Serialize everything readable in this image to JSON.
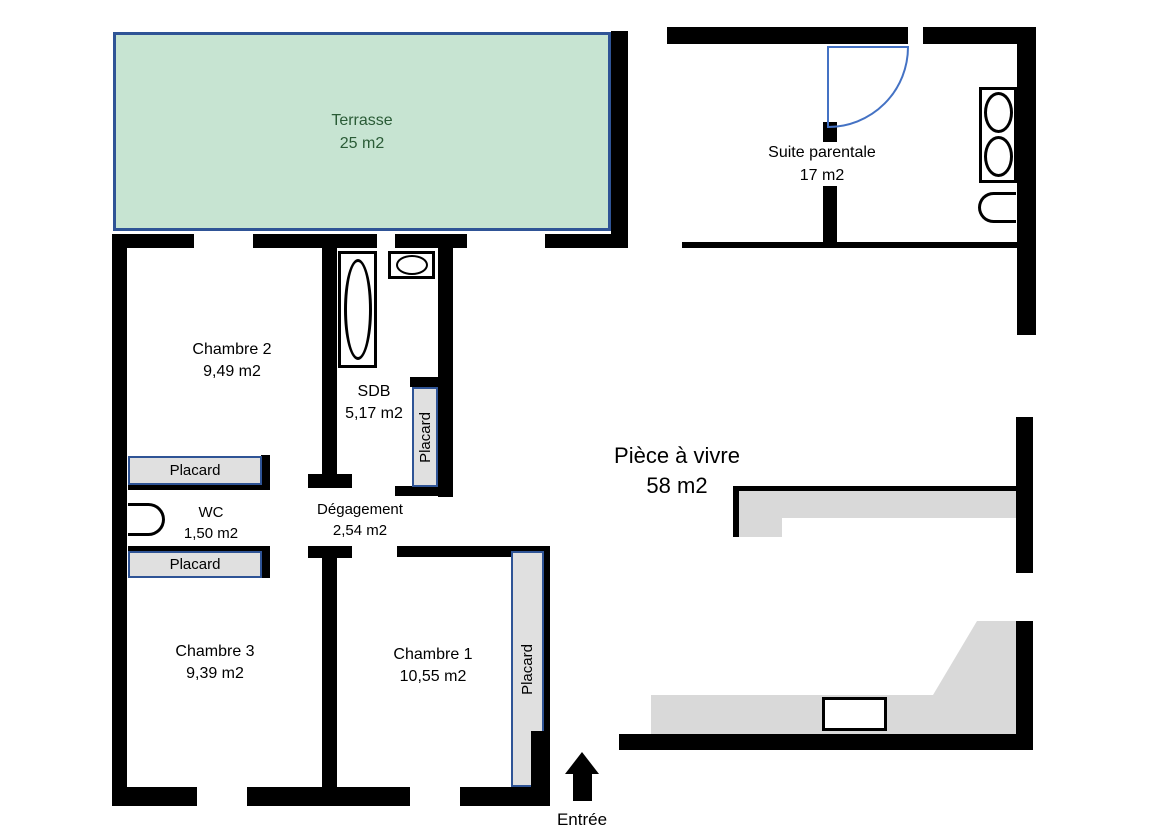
{
  "rooms": {
    "terrasse": {
      "name": "Terrasse",
      "area": "25 m2"
    },
    "suite_parentale": {
      "name": "Suite parentale",
      "area": "17 m2"
    },
    "chambre2": {
      "name": "Chambre 2",
      "area": "9,49 m2"
    },
    "sdb": {
      "name": "SDB",
      "area": "5,17 m2"
    },
    "wc": {
      "name": "WC",
      "area": "1,50 m2"
    },
    "degagement": {
      "name": "Dégagement",
      "area": "2,54 m2"
    },
    "chambre3": {
      "name": "Chambre 3",
      "area": "9,39 m2"
    },
    "chambre1": {
      "name": "Chambre 1",
      "area": "10,55 m2"
    },
    "piece_a_vivre": {
      "name": "Pièce à vivre",
      "area": "58 m2"
    }
  },
  "closets": {
    "label": "Placard"
  },
  "entry": {
    "label": "Entrée"
  },
  "colors": {
    "wall": "#000000",
    "terrace_fill": "#c7e4d2",
    "terrace_border": "#2f5496",
    "terrace_text": "#2a5b36",
    "closet_fill": "#e0e0e0",
    "closet_border": "#2f5496",
    "counter_fill": "#d9d9d9",
    "door_arc": "#4472c4",
    "background": "#ffffff"
  }
}
